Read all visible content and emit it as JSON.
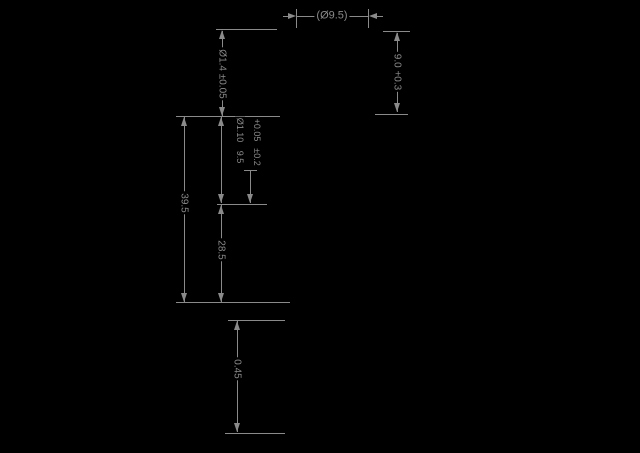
{
  "drawing": {
    "type": "technical-dimension-diagram",
    "background_color": "#000000",
    "line_color": "#8a8a8a",
    "labels": {
      "top_diameter": "(Ø9.5)",
      "tip_height": "Ø1.4 ±0.05",
      "right_depth": "9.0 +0.3",
      "overall_length": "39.5",
      "inner_diameter": "Ø1.10",
      "inner_diameter_tol": "+0.05",
      "inner_gap": "9.5",
      "inner_gap_tol": "±0.2",
      "lower_section_length": "28.5",
      "bottom_section_length": "0.45"
    }
  }
}
